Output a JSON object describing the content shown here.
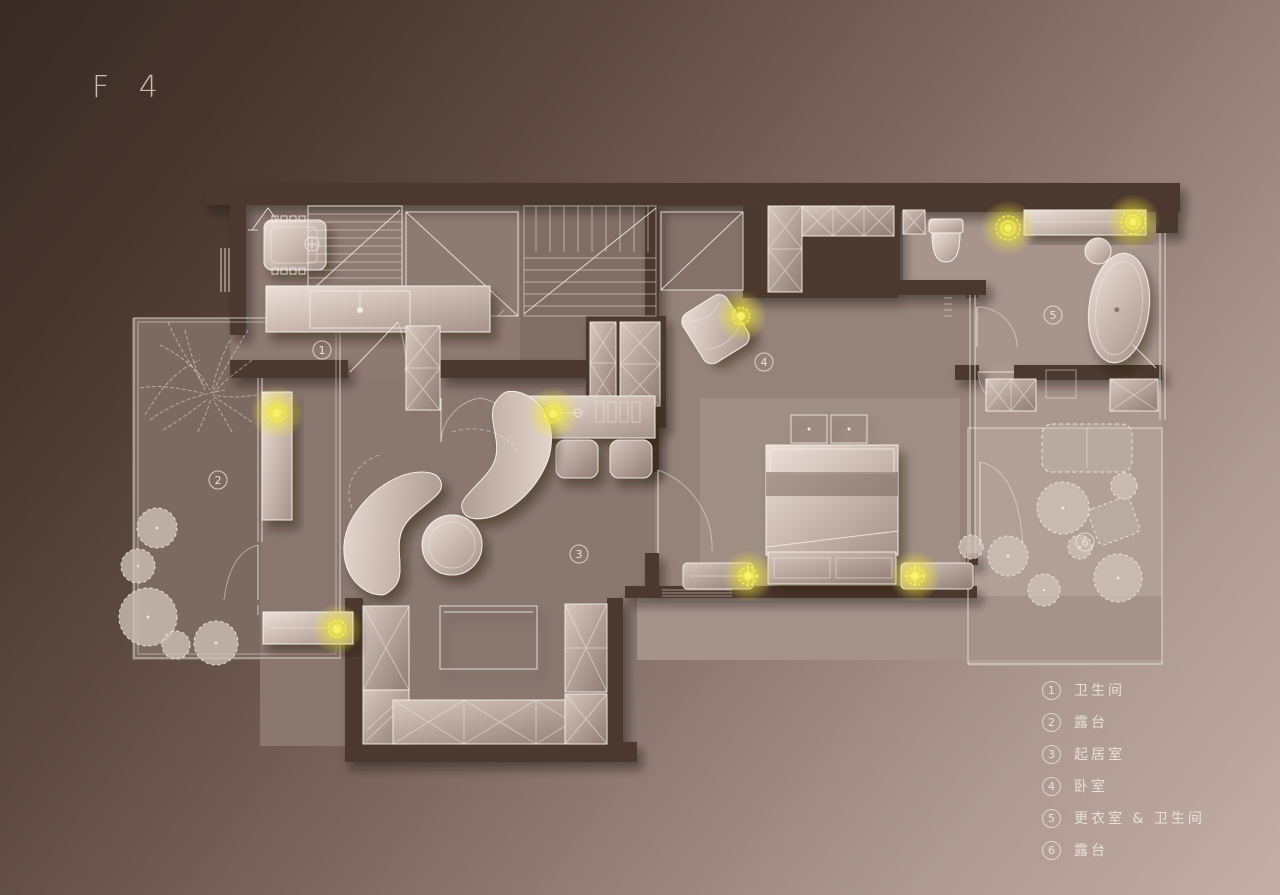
{
  "title": "F 4",
  "legend": {
    "items": [
      {
        "number": "1",
        "label": "卫生间"
      },
      {
        "number": "2",
        "label": "露台"
      },
      {
        "number": "3",
        "label": "起居室"
      },
      {
        "number": "4",
        "label": "卧室"
      },
      {
        "number": "5",
        "label": "更衣室 & 卫生间"
      },
      {
        "number": "6",
        "label": "露台"
      }
    ]
  },
  "plan": {
    "room_markers": [
      {
        "number": "1",
        "name": "bathroom"
      },
      {
        "number": "2",
        "name": "terrace"
      },
      {
        "number": "3",
        "name": "living-room"
      },
      {
        "number": "4",
        "name": "bedroom"
      },
      {
        "number": "5",
        "name": "dressing-room-bathroom"
      },
      {
        "number": "6",
        "name": "terrace"
      }
    ]
  },
  "colors": {
    "background_dark": "#392c26",
    "background_light": "#c3aea8",
    "wall": "#4b382f",
    "floor": "#897770",
    "furniture_light": "#d6c7bf",
    "light_accent": "#f2e93f",
    "line": "#efe5dd",
    "text": "#e9ded6"
  }
}
